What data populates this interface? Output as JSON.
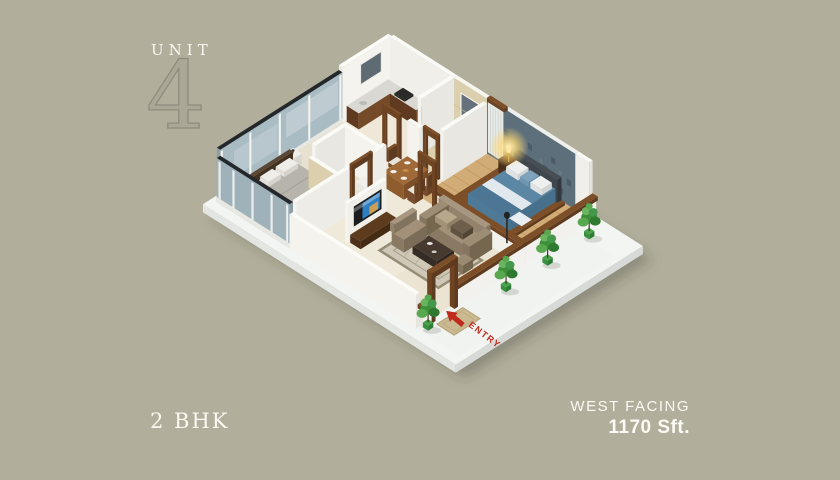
{
  "header": {
    "unit_label": "UNIT",
    "unit_number": "4"
  },
  "footer": {
    "configuration": "2 BHK",
    "facing": "WEST FACING",
    "area": "1170 Sft."
  },
  "scene": {
    "entry_label": "ENTRY",
    "rooms": [
      "living-room",
      "dining",
      "kitchen",
      "master-bedroom",
      "bedroom-2",
      "bathroom-1",
      "bathroom-2",
      "entry-sitout"
    ],
    "furniture": [
      "blue-double-bed",
      "gray-double-bed",
      "sofa-set",
      "coffee-table",
      "dining-table-four-chairs",
      "tv-unit",
      "kitchen-l-counter",
      "bedside-lamp",
      "potted-plants",
      "door-mat"
    ]
  },
  "colors": {
    "background": "#b1ae9b",
    "text_white": "#faf8f1",
    "numeral_outline": "#8e8c7d",
    "entry_red": "#bf2a1d",
    "accent_wall": "#5d6f7a",
    "glass": "#a9bbc3",
    "glass_cap": "#24282b",
    "wall_white": "#f4f3ee",
    "wood_dark": "#6e4423",
    "floor_cream": "#ebe4d3",
    "floor_tile": "#dbcfae",
    "floor_wood": "#d2ac76",
    "terrace_white": "#f3f5f2",
    "bed_blue": "#5b87a5",
    "bed_gray": "#b7b4ac",
    "sofa_taupe": "#8a7a63",
    "plant_green": "#4c9b45",
    "rug": "#cfc8b6"
  }
}
